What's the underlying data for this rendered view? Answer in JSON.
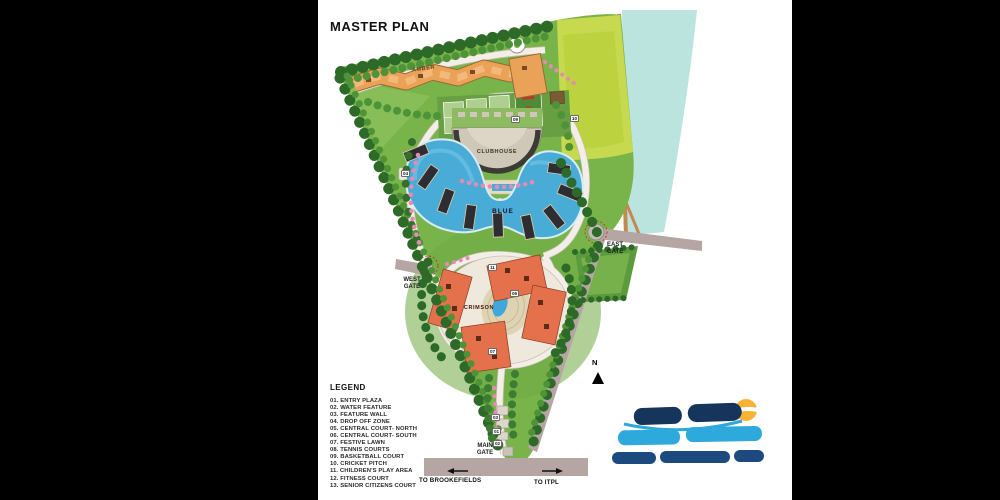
{
  "title": "MASTER PLAN",
  "map": {
    "zone_labels": {
      "amber": "AMBER",
      "blue": "BLUE",
      "crimson": "CRIMSON",
      "clubhouse": "CLUBHOUSE"
    },
    "gates": {
      "west": "WEST GATE",
      "east": "EAST GATE",
      "main": "MAIN GATE"
    },
    "north_label": "N",
    "directions": {
      "left": "TO BROOKEFIELDS",
      "right": "TO ITPL"
    },
    "markers": [
      {
        "label": "04"
      },
      {
        "label": "09"
      },
      {
        "label": "10"
      },
      {
        "label": "11"
      },
      {
        "label": "06"
      },
      {
        "label": "07"
      },
      {
        "label": "03"
      },
      {
        "label": "01"
      },
      {
        "label": "02"
      }
    ]
  },
  "legend": {
    "title": "LEGEND",
    "items": [
      "01. ENTRY PLAZA",
      "02. WATER FEATURE",
      "03. FEATURE WALL",
      "04. DROP OFF ZONE",
      "05. CENTRAL COURT- NORTH",
      "06. CENTRAL COURT- SOUTH",
      "07. FESTIVE LAWN",
      "08. TENNIS COURTS",
      "09. BASKETBALL COURT",
      "10. CRICKET PITCH",
      "11. CHILDREN'S PLAY AREA",
      "12. FITNESS COURT",
      "13. SENIOR CITIZENS COURT"
    ]
  },
  "colors": {
    "site_green": "#79b44a",
    "lime_field": "#c6d94f",
    "lake_teal": "#bce4df",
    "water_blue": "#49acd6",
    "amber_building": "#e9a258",
    "crimson_building": "#e4714b",
    "road_mauve": "#b5a5a3",
    "logo_sun": "#f9b233",
    "logo_navy": "#16355d",
    "logo_blue": "#2ea9dc"
  }
}
